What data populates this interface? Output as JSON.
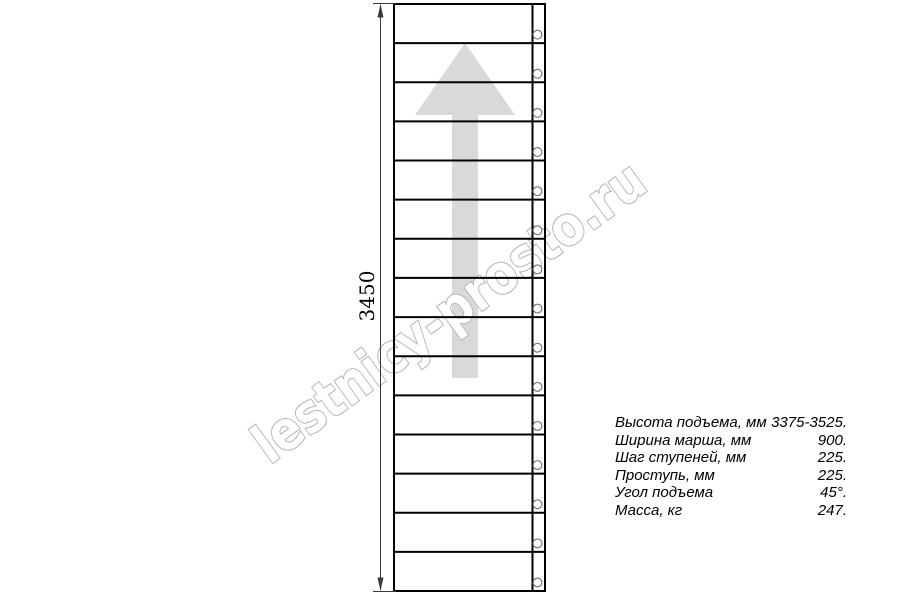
{
  "watermark": {
    "text": "lestnicy-prosto.ru",
    "color": "#b8b8b8"
  },
  "dimension": {
    "label": "3450"
  },
  "stair": {
    "step_count": 15,
    "direction_arrow": "up",
    "arrow_color": "#d9d9d9",
    "line_color": "#000000"
  },
  "specs": {
    "rows": [
      {
        "label": "Высота подъема, мм",
        "value": "3375-3525."
      },
      {
        "label": "Ширина марша, мм",
        "value": "900."
      },
      {
        "label": "Шаг ступеней, мм",
        "value": "225."
      },
      {
        "label": "Проступь, мм",
        "value": "225."
      },
      {
        "label": "Угол подъема",
        "value": "45°."
      },
      {
        "label": "Масса, кг",
        "value": "247."
      }
    ]
  }
}
